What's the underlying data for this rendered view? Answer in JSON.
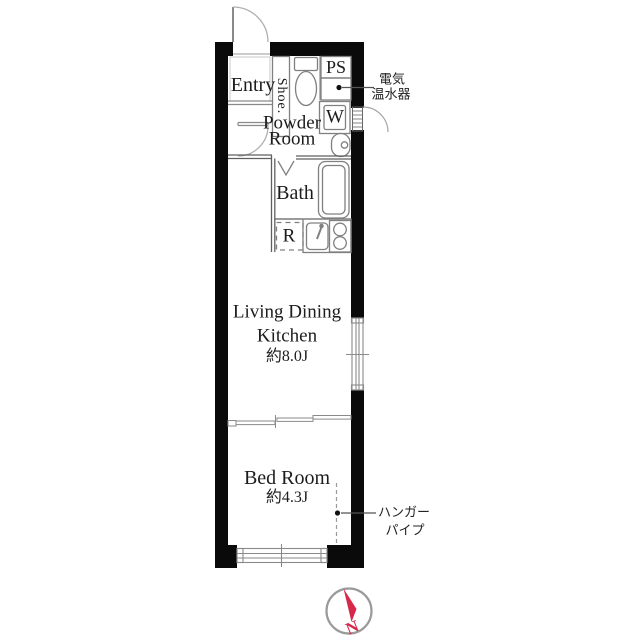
{
  "rooms": {
    "entry": {
      "label": "Entry"
    },
    "shoe": {
      "label": "Shoe."
    },
    "ps": {
      "label": "PS"
    },
    "washer": {
      "label": "W"
    },
    "powder": {
      "line1": "Powder",
      "line2": "Room"
    },
    "bath": {
      "label": "Bath"
    },
    "fridge": {
      "label": "R"
    },
    "ldk": {
      "line1": "Living Dining",
      "line2": "Kitchen",
      "size": "約8.0J"
    },
    "bedroom": {
      "label": "Bed Room",
      "size": "約4.3J"
    }
  },
  "annotations": {
    "water_heater": {
      "line1": "電気",
      "line2": "温水器"
    },
    "hanger_pipe": {
      "line1": "ハンガー",
      "line2": "パイプ"
    }
  },
  "compass": {
    "north": "N"
  },
  "colors": {
    "wall": "#0a0a0a",
    "fixture_line": "#808080",
    "needle_red": "#d7284a"
  }
}
